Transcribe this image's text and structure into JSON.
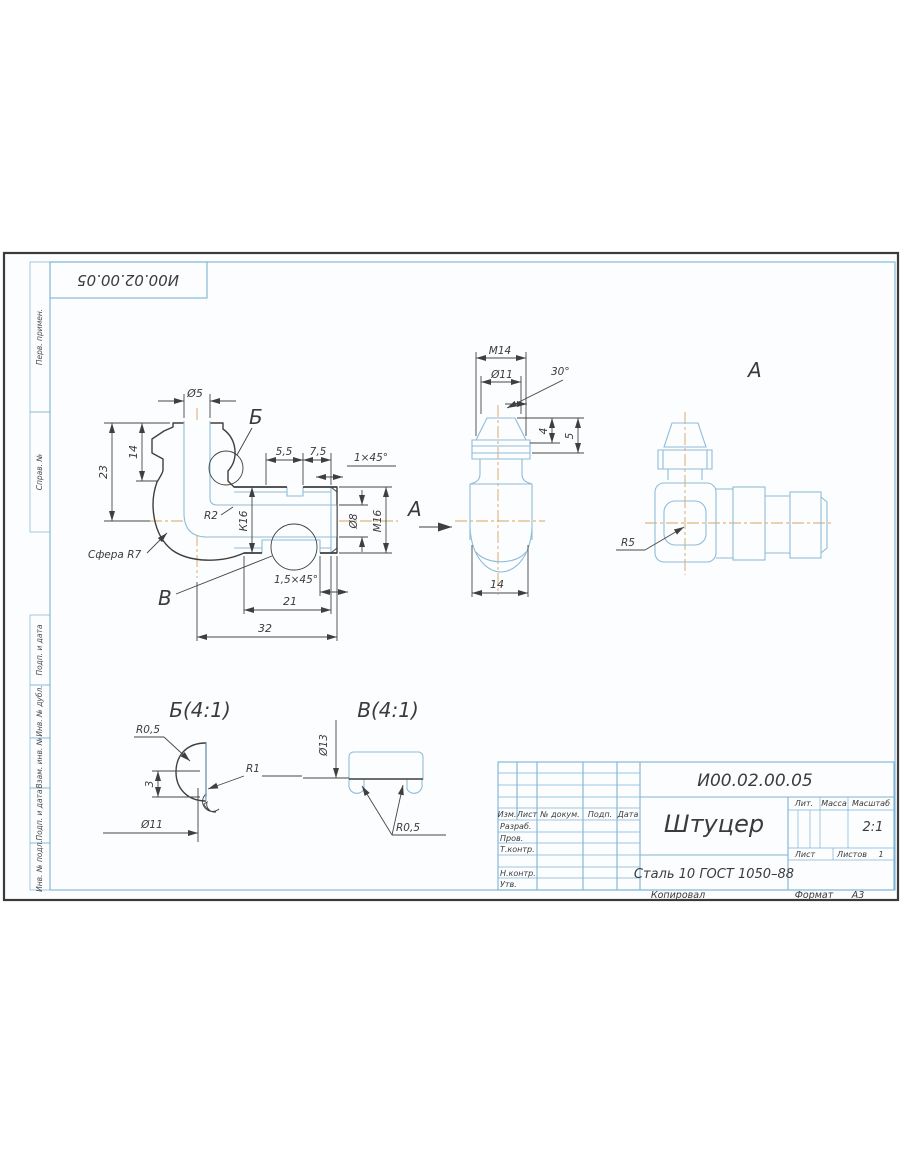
{
  "stamp_top": {
    "designation_inverted": "И00.02.00.05"
  },
  "margin_labels": {
    "pp": "Перв. примен.",
    "sn": "Справ. №",
    "pd1": "Подп. и дата",
    "id": "Инв. № дубл.",
    "vi": "Взам. инв. №",
    "pd2": "Подп. и дата",
    "ip": "Инв. № подл."
  },
  "views": {
    "main": {
      "dims": {
        "d5": "Ø5",
        "h23": "23",
        "h14": "14",
        "detail_b_ref": "Б",
        "w55": "5,5",
        "w75": "7,5",
        "chamfer1": "1×45°",
        "r2": "R2",
        "k16": "К16",
        "d8": "Ø8",
        "m16": "М16",
        "view_a_ref": "А",
        "sphere_r7": "Сфера R7",
        "detail_v_ref": "В",
        "chamfer15": "1,5×45°",
        "w21": "21",
        "w32": "32"
      }
    },
    "end": {
      "dims": {
        "m14": "М14",
        "d11": "Ø11",
        "a30": "30°",
        "h4": "4",
        "h5": "5",
        "w14": "14"
      }
    },
    "side": {
      "label": "А",
      "r5": "R5"
    },
    "detail_b": {
      "title": "Б(4:1)",
      "dims": {
        "r05": "R0,5",
        "r1": "R1",
        "h3": "3",
        "d11": "Ø11"
      }
    },
    "detail_v": {
      "title": "В(4:1)",
      "dims": {
        "d13": "Ø13",
        "r05": "R0,5"
      }
    }
  },
  "title_block": {
    "designation": "И00.02.00.05",
    "part_name": "Штуцер",
    "material": "Сталь 10 ГОСТ 1050–88",
    "header_cols": {
      "izm": "Изм.",
      "list": "Лист",
      "n_dokum": "№ докум.",
      "podp": "Подп.",
      "data": "Дата"
    },
    "rows": {
      "razrab": "Разраб.",
      "prov": "Пров.",
      "t_kontr": "Т.контр.",
      "n_kontr": "Н.контр.",
      "utv": "Утв."
    },
    "right": {
      "lit": "Лит.",
      "massa": "Масса",
      "masshtab": "Масштаб",
      "scale": "2:1",
      "list": "Лист",
      "listov": "Листов",
      "listov_value": "1"
    },
    "footer": {
      "kopiroval": "Копировал",
      "format_label": "Формат",
      "format_value": "А3"
    }
  }
}
